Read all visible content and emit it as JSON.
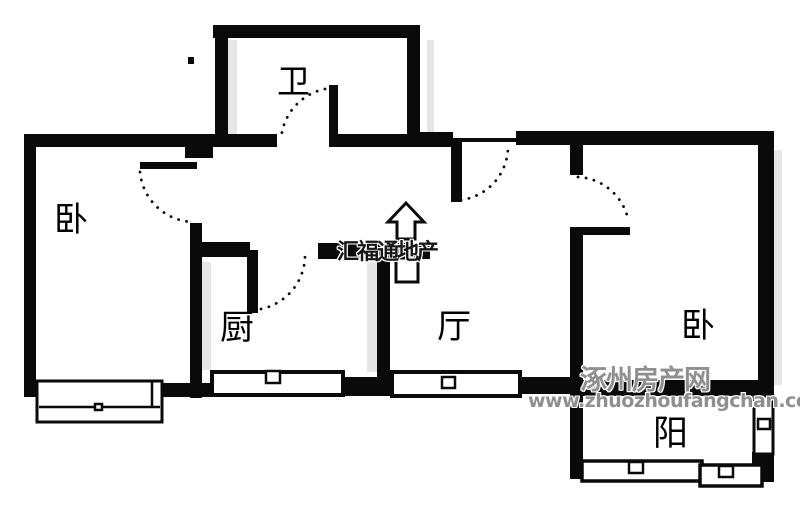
{
  "plan": {
    "width": 800,
    "height": 509,
    "colors": {
      "wall": "#0a0a0a",
      "background": "#ffffff",
      "shadow": "#e6e6e6",
      "window_fill": "#ffffff"
    },
    "walls": [
      [
        213,
        25,
        207,
        13
      ],
      [
        215,
        25,
        13,
        122
      ],
      [
        407,
        25,
        13,
        122
      ],
      [
        24,
        134,
        161,
        13
      ],
      [
        185,
        134,
        28,
        24
      ],
      [
        213,
        134,
        64,
        13
      ],
      [
        337,
        134,
        83,
        13
      ],
      [
        24,
        134,
        12,
        263
      ],
      [
        190,
        223,
        12,
        175
      ],
      [
        420,
        132,
        33,
        15
      ],
      [
        516,
        131,
        258,
        14
      ],
      [
        570,
        145,
        13,
        30
      ],
      [
        570,
        227,
        13,
        166
      ],
      [
        758,
        131,
        16,
        262
      ],
      [
        202,
        242,
        48,
        15
      ],
      [
        318,
        243,
        112,
        16
      ],
      [
        377,
        258,
        13,
        127
      ],
      [
        162,
        383,
        50,
        14
      ],
      [
        340,
        377,
        52,
        19
      ],
      [
        520,
        377,
        52,
        17
      ],
      [
        570,
        380,
        204,
        16
      ],
      [
        570,
        383,
        13,
        96
      ],
      [
        752,
        452,
        22,
        30
      ],
      [
        453,
        138,
        64,
        4
      ],
      [
        188,
        57,
        6,
        7
      ]
    ],
    "shadows": [
      [
        228,
        40,
        9,
        95
      ],
      [
        427,
        40,
        7,
        92
      ],
      [
        202,
        262,
        9,
        108
      ],
      [
        367,
        262,
        10,
        110
      ],
      [
        774,
        150,
        8,
        235
      ]
    ],
    "windows": [
      {
        "x": 37,
        "y": 381,
        "w": 125,
        "h": 41,
        "stroke": 3,
        "mid_y": 407,
        "vline_x": 152,
        "marker": [
          95,
          404,
          7,
          6
        ]
      },
      {
        "x": 212,
        "y": 372,
        "w": 131,
        "h": 23,
        "stroke": 4,
        "marker": [
          266,
          371,
          14,
          12
        ]
      },
      {
        "x": 392,
        "y": 372,
        "w": 128,
        "h": 24,
        "stroke": 4,
        "marker": [
          442,
          377,
          13,
          11
        ]
      },
      {
        "x": 582,
        "y": 461,
        "w": 120,
        "h": 20,
        "stroke": 3.5,
        "marker": [
          629,
          462,
          14,
          11
        ]
      },
      {
        "x": 700,
        "y": 465,
        "w": 62,
        "h": 21,
        "stroke": 3.5,
        "marker": [
          719,
          466,
          14,
          11
        ]
      },
      {
        "x": 754,
        "y": 396,
        "w": 19,
        "h": 58,
        "stroke": 3,
        "marker": [
          758,
          419,
          12,
          10
        ]
      }
    ],
    "fixtures": [
      {
        "x": 396,
        "y": 258,
        "w": 22,
        "h": 24,
        "stroke": 3
      }
    ],
    "door_leaves": [
      [
        140,
        162,
        57,
        7
      ],
      [
        247,
        250,
        11,
        63
      ],
      [
        329,
        85,
        9,
        62
      ],
      [
        451,
        138,
        11,
        64
      ],
      [
        572,
        227,
        58,
        8
      ]
    ],
    "door_arcs": [
      "M140,172 A55,55 0 0 0 194,222",
      "M253,310 A55,55 0 0 0 305,256",
      "M333,88 A55,55 0 0 0 281,140",
      "M461,200 A54,54 0 0 0 508,147",
      "M578,177 A54,54 0 0 1 628,219"
    ],
    "arrow": {
      "points": "406,203 388,222 397,222 397,239 415,239 415,222 424,222",
      "stroke": 3
    }
  },
  "rooms": [
    {
      "id": "bedroom-left",
      "label": "卧",
      "x": 54,
      "y": 203,
      "size": 34
    },
    {
      "id": "bathroom",
      "label": "卫",
      "x": 277,
      "y": 65,
      "size": 33
    },
    {
      "id": "kitchen",
      "label": "厨",
      "x": 220,
      "y": 311,
      "size": 34
    },
    {
      "id": "living-room",
      "label": "厅",
      "x": 437,
      "y": 310,
      "size": 34
    },
    {
      "id": "bedroom-right",
      "label": "卧",
      "x": 681,
      "y": 309,
      "size": 34
    },
    {
      "id": "balcony",
      "label": "阳",
      "x": 653,
      "y": 417,
      "size": 35
    }
  ],
  "watermarks": {
    "agency": {
      "text": "汇福通地产",
      "x": 337,
      "y": 242,
      "size": 22,
      "color": "#161616"
    },
    "site": {
      "text": "涿州房产网",
      "x": 580,
      "y": 367,
      "size": 27,
      "color": "#8f8f8f"
    },
    "url": {
      "text": "www.zhuozhoufangchan.com",
      "x": 528,
      "y": 392,
      "size": 19,
      "color": "#8f8f8f"
    }
  }
}
